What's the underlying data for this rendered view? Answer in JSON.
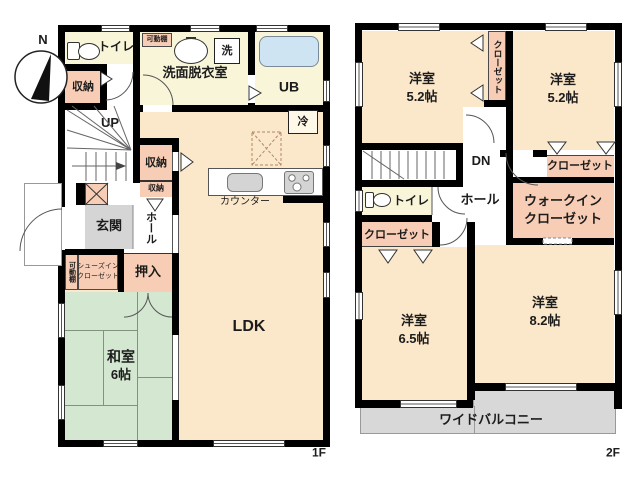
{
  "compass": {
    "north_label": "N"
  },
  "colors": {
    "wall": "#000000",
    "room_main": "#fbe7c9",
    "room_wet": "#f8f5d8",
    "storage_pink": "#f8cdb5",
    "tatami_green": "#d3e7d1",
    "entry_gray": "#d5d5d5",
    "balcony_gray": "#d8d8d8",
    "bath_blue": "#cfe4f2",
    "appliance_gray": "#d4d4d4"
  },
  "floor1": {
    "floor_label": "1F",
    "toilet": "トイレ",
    "movable_shelf_top": "可動棚",
    "washroom": "洗面脱衣室",
    "washer": "洗",
    "unit_bath": "UB",
    "storage_a": "収納",
    "stairs_up": "UP",
    "storage_b": "収納",
    "storage_c": "収納",
    "fridge": "冷",
    "counter": "カウンター",
    "entrance": "玄関",
    "hall": "ホール",
    "movable_shelf_left": "可動棚",
    "shoes_closet_line1": "シューズイン",
    "shoes_closet_line2": "クローゼット",
    "oshiire": "押入",
    "japanese_room_line1": "和室",
    "japanese_room_line2": "6帖",
    "ldk": "LDK"
  },
  "floor2": {
    "floor_label": "2F",
    "bedroom_nw_line1": "洋室",
    "bedroom_nw_line2": "5.2帖",
    "closet_vertical": "クローゼット",
    "bedroom_ne_line1": "洋室",
    "bedroom_ne_line2": "5.2帖",
    "stairs_down": "DN",
    "toilet": "トイレ",
    "hall": "ホール",
    "closet_east": "クローゼット",
    "walkin_line1": "ウォークイン",
    "walkin_line2": "クローゼット",
    "closet_west": "クローゼット",
    "bedroom_sw_line1": "洋室",
    "bedroom_sw_line2": "6.5帖",
    "bedroom_se_line1": "洋室",
    "bedroom_se_line2": "8.2帖",
    "balcony": "ワイドバルコニー"
  }
}
